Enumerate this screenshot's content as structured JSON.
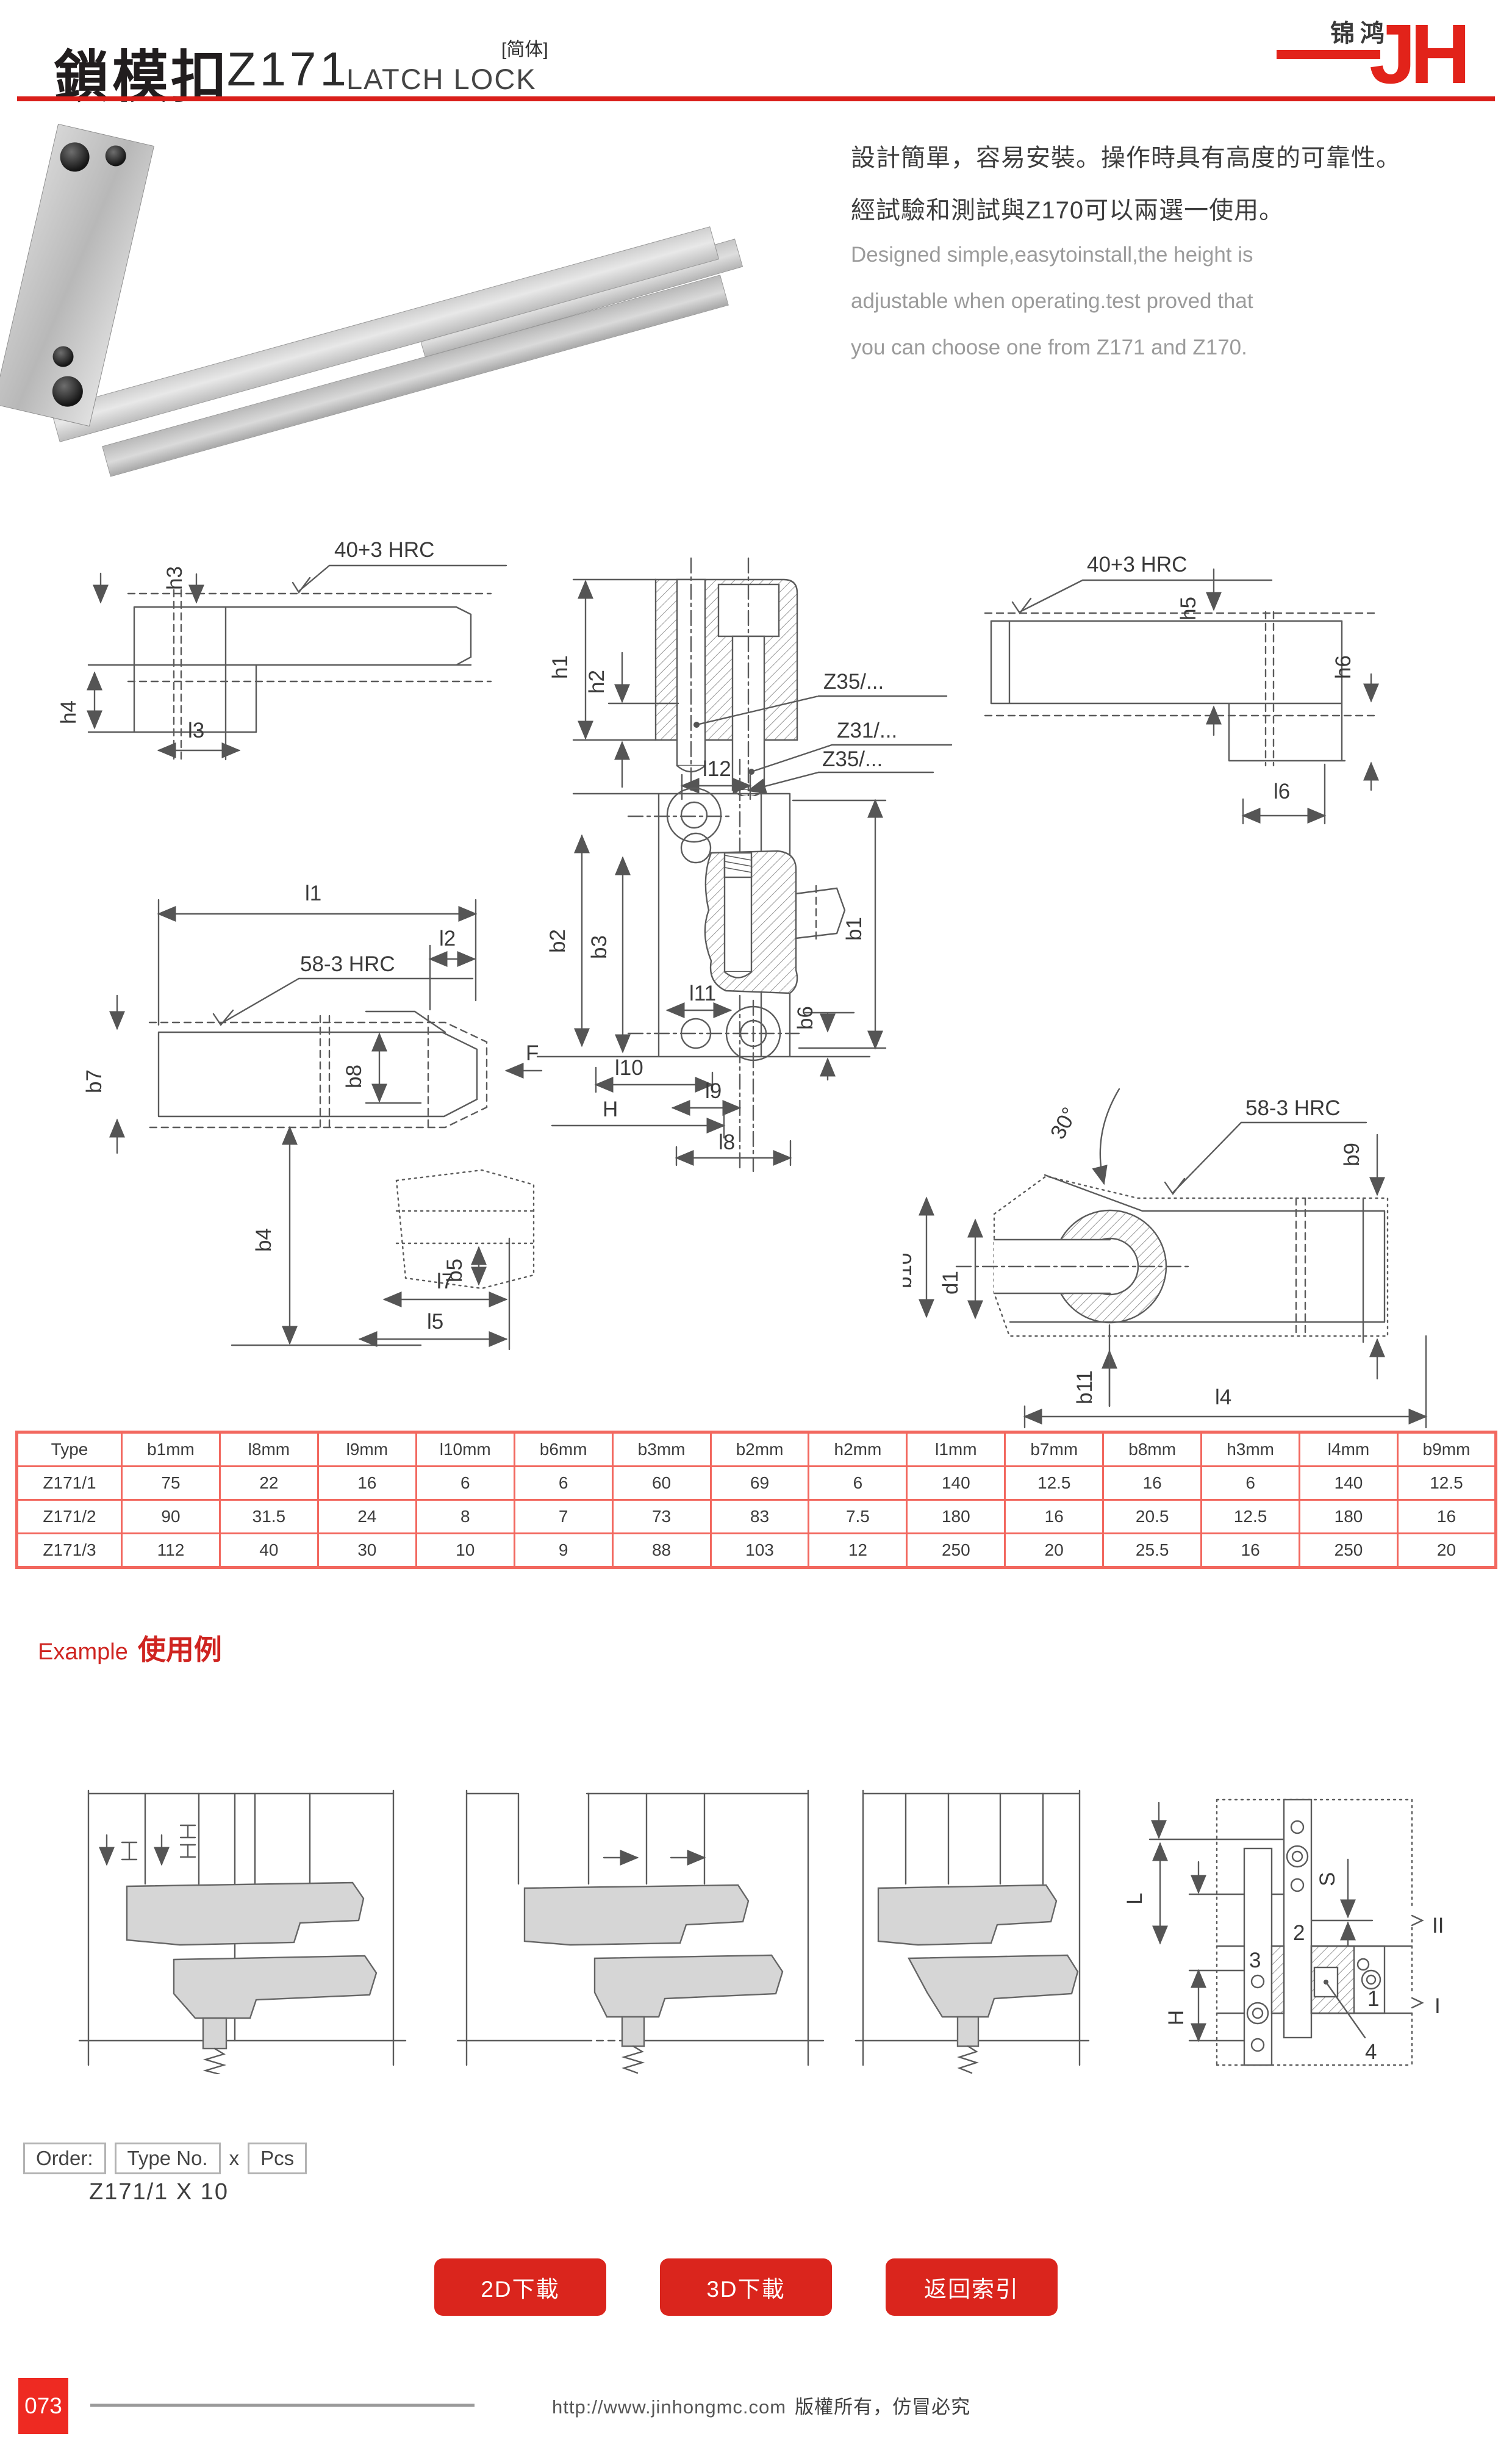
{
  "header": {
    "title_cn": "鎖模扣",
    "model": "Z171",
    "title_en": "LATCH LOCK",
    "lang_tag": "[简体]"
  },
  "logo": {
    "brand_cn": "锦鸿",
    "brand_letters": "JH"
  },
  "description": {
    "cn1": "設計簡單，容易安裝。操作時具有高度的可靠性。",
    "cn2": "經試驗和測試與Z170可以兩選一使用。",
    "en1": "Designed simple,easytoinstall,the height is",
    "en2": "adjustable when operating.test proved that",
    "en3": "you can choose one from Z171 and Z170."
  },
  "drawings": {
    "hrc40": "40+3 HRC",
    "hrc58": "58-3 HRC",
    "angle30": "30°",
    "z35": "Z35/...",
    "z31": "Z31/...",
    "dims": {
      "h1": "h1",
      "h2": "h2",
      "h3": "h3",
      "h4": "h4",
      "h5": "h5",
      "h6": "h6",
      "l1": "l1",
      "l2": "l2",
      "l3": "l3",
      "l4": "l4",
      "l5": "l5",
      "l6": "l6",
      "l7": "l7",
      "l8": "l8",
      "l9": "l9",
      "l10": "l10",
      "l11": "l11",
      "l12": "l12",
      "b1": "b1",
      "b2": "b2",
      "b3": "b3",
      "b4": "b4",
      "b5": "b5",
      "b6": "b6",
      "b7": "b7",
      "b8": "b8",
      "b9": "b9",
      "b10": "b10",
      "b11": "b11",
      "d1": "d1",
      "F": "F",
      "H": "H"
    }
  },
  "table": {
    "headers": [
      "Type",
      "b1mm",
      "l8mm",
      "l9mm",
      "l10mm",
      "b6mm",
      "b3mm",
      "b2mm",
      "h2mm",
      "l1mm",
      "b7mm",
      "b8mm",
      "h3mm",
      "l4mm",
      "b9mm"
    ],
    "rows": [
      [
        "Z171/1",
        "75",
        "22",
        "16",
        "6",
        "6",
        "60",
        "69",
        "6",
        "140",
        "12.5",
        "16",
        "6",
        "140",
        "12.5"
      ],
      [
        "Z171/2",
        "90",
        "31.5",
        "24",
        "8",
        "7",
        "73",
        "83",
        "7.5",
        "180",
        "16",
        "20.5",
        "12.5",
        "180",
        "16"
      ],
      [
        "Z171/3",
        "112",
        "40",
        "30",
        "10",
        "9",
        "88",
        "103",
        "12",
        "250",
        "20",
        "25.5",
        "16",
        "250",
        "20"
      ]
    ]
  },
  "example": {
    "label_en": "Example",
    "label_cn": "使用例",
    "parts": {
      "p1": "1",
      "p2": "2",
      "p3": "3",
      "p4": "4"
    },
    "dims": {
      "L": "L",
      "S": "S",
      "H": "H",
      "stage1": "I",
      "stage2": "II"
    }
  },
  "order": {
    "label": "Order:",
    "type_label": "Type No.",
    "times": "x",
    "pcs_label": "Pcs",
    "sample": "Z171/1 X 10"
  },
  "buttons": [
    {
      "label": "2D下載"
    },
    {
      "label": "3D下載"
    },
    {
      "label": "返回索引"
    }
  ],
  "footer": {
    "page": "073",
    "url": "http://www.jinhongmc.com",
    "notice": "版權所有，仿冒必究"
  },
  "colors": {
    "accent_red": "#da1f1a",
    "table_border": "#f2685f",
    "button_red": "#da251d",
    "page_num_red": "#ee2a22"
  }
}
